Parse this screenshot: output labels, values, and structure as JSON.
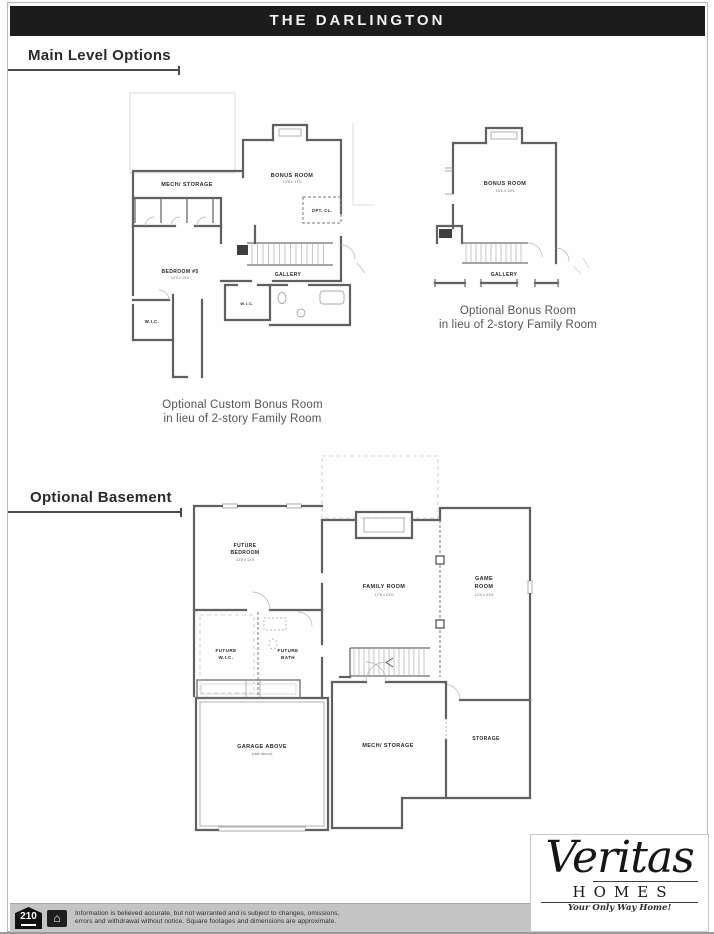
{
  "header": {
    "title": "THE DARLINGTON"
  },
  "sections": {
    "main_level_heading": "Main Level Options",
    "basement_heading": "Optional Basement"
  },
  "plan_custom_bonus": {
    "caption_line1": "Optional Custom Bonus Room",
    "caption_line2": "in lieu of 2-story Family Room",
    "rooms": {
      "mech_storage": "MECH/ STORAGE",
      "bonus_room": "BONUS ROOM",
      "bonus_room_dims": "13'6 x 17'0",
      "opt_cl": "OPT. CL.",
      "bedroom5": "BEDROOM #5",
      "bedroom5_dims": "12'0 x 13'6",
      "gallery": "GALLERY",
      "wic_center": "W.I.C.",
      "wic_left": "W.I.C."
    }
  },
  "plan_bonus": {
    "caption_line1": "Optional Bonus Room",
    "caption_line2": "in lieu of 2-story Family Room",
    "rooms": {
      "bonus_room": "BONUS ROOM",
      "bonus_room_dims": "15'6 x 19'4",
      "gallery": "GALLERY"
    }
  },
  "plan_basement": {
    "rooms": {
      "future_bedroom_l1": "FUTURE",
      "future_bedroom_l2": "BEDROOM",
      "future_bedroom_dims": "12'8 x 13'0",
      "family_room": "FAMILY ROOM",
      "family_room_dims": "17'8 x 21'0",
      "game_room_l1": "GAME",
      "game_room_l2": "ROOM",
      "game_room_dims": "12'4 x 21'6",
      "future_wic_l1": "FUTURE",
      "future_wic_l2": "W.I.C.",
      "future_bath_l1": "FUTURE",
      "future_bath_l2": "BATH",
      "garage_above": "GARAGE ABOVE",
      "garage_above_sub": "(slab above)",
      "mech_storage": "MECH/ STORAGE",
      "storage": "STORAGE"
    }
  },
  "logo": {
    "name": "Veritas",
    "sub": "HOMES",
    "tagline": "Your Only Way Home!"
  },
  "footer": {
    "badge_210": "210",
    "house_icon_glyph": "⌂",
    "disclaimer_line1": "Information is believed accurate, but not warranted and is subject to changes, omissions,",
    "disclaimer_line2": "errors and withdrawal without notice.  Square footages and dimensions are approximate."
  }
}
